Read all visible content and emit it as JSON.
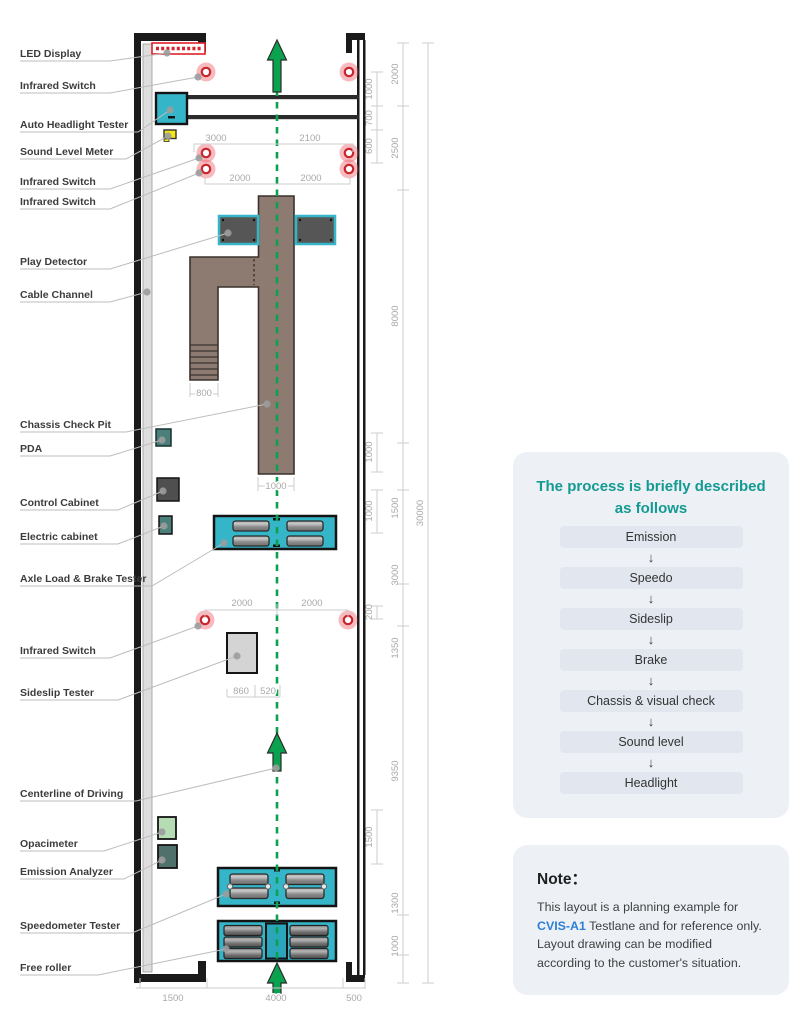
{
  "colors": {
    "equipment_cyan": "#35b6c8",
    "centerline_green": "#0aa14f",
    "infrared_pink": "#ee5a66",
    "infrared_ring_red": "#c9252c",
    "led_red": "#e02128",
    "pit_brown": "#8d7b72",
    "sound_meter_yellow": "#f4e716",
    "process_title_teal": "#149a92",
    "note_link_blue": "#2d7fd3",
    "panel_bg": "#edf1f6",
    "dim_gray": "#a9a9a9"
  },
  "plan": {
    "labels": [
      "LED Display",
      "Infrared Switch",
      "Auto Headlight Tester",
      "Sound Level Meter",
      "Infrared Switch",
      "Infrared Switch",
      "Play Detector",
      "Cable Channel",
      "Chassis Check Pit",
      "PDA",
      "Control Cabinet",
      "Electric cabinet",
      "Axle Load & Brake Tester",
      "Infrared Switch",
      "Sideslip Tester",
      "Centerline of Driving",
      "Opacimeter",
      "Emission Analyzer",
      "Speedometer Tester",
      "Free roller"
    ],
    "dims": {
      "top_row1": [
        "3000",
        "2100"
      ],
      "top_row2": [
        "2000",
        "2000"
      ],
      "stairs_width": "800",
      "pit_width": "1000",
      "mid_row": [
        "2000",
        "2000"
      ],
      "sideslip_row": [
        "860",
        "520"
      ],
      "bottom_row": [
        "1500",
        "4000",
        "500"
      ],
      "right_inner": [
        "1000",
        "700",
        "600",
        "1000",
        "1000",
        "200",
        "1500"
      ],
      "right_outer": [
        "2000",
        "2500",
        "8000",
        "1500",
        "3000",
        "1350",
        "9350",
        "1300",
        "1000"
      ],
      "total_length": "30000"
    }
  },
  "process": {
    "title_line1": "The process is briefly described",
    "title_line2": "as follows",
    "arrow": "↓",
    "steps": [
      "Emission",
      "Speedo",
      "Sideslip",
      "Brake",
      "Chassis & visual check",
      "Sound level",
      "Headlight"
    ]
  },
  "note": {
    "title": "Note：",
    "body_prefix": "This layout is a planning example for ",
    "highlight": "CVIS-A1",
    "body_suffix": " Testlane and for reference only. Layout drawing can be modified according to the customer's situation."
  }
}
